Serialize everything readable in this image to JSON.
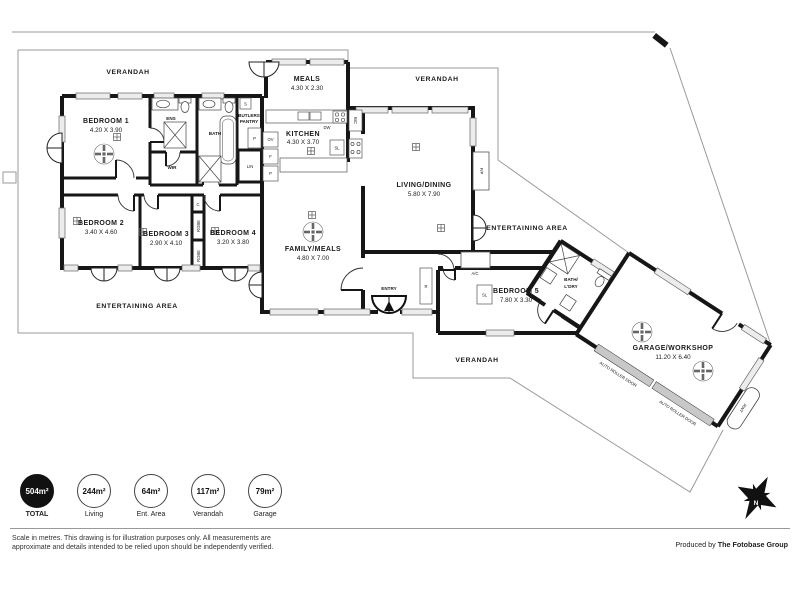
{
  "plan": {
    "verandah_nw": "VERANDAH",
    "verandah_ne": "VERANDAH",
    "verandah_s": "VERANDAH",
    "entertaining_w": "ENTERTAINING AREA",
    "entertaining_e": "ENTERTAINING AREA",
    "rooms": {
      "bedroom1": {
        "name": "BEDROOM 1",
        "dims": "4.20 X 3.90"
      },
      "bedroom2": {
        "name": "BEDROOM 2",
        "dims": "3.40 X 4.60"
      },
      "bedroom3": {
        "name": "BEDROOM 3",
        "dims": "2.90 X 4.10"
      },
      "bedroom4": {
        "name": "BEDROOM 4",
        "dims": "3.20 X 3.80"
      },
      "bedroom5": {
        "name": "BEDROOM 5",
        "dims": "7.80 X 3.30"
      },
      "meals": {
        "name": "MEALS",
        "dims": "4.30 X 2.30"
      },
      "kitchen": {
        "name": "KITCHEN",
        "dims": "4.30 X 3.70"
      },
      "family": {
        "name": "FAMILY/MEALS",
        "dims": "4.80 X 7.00"
      },
      "living": {
        "name": "LIVING/DINING",
        "dims": "5.80 X 7.90"
      },
      "garage": {
        "name": "GARAGE/WORKSHOP",
        "dims": "11.20 X 6.40"
      },
      "ens": "ENS",
      "bath": "BATH",
      "wir": "WIR",
      "butlers": {
        "line1": "BUTLERS",
        "line2": "PANTRY"
      },
      "bathldry": {
        "line1": "BATH/",
        "line2": "L'DRY"
      },
      "entry": "ENTRY"
    },
    "small": {
      "dw": "DW",
      "bic": "BIC",
      "sl": "SL",
      "sl_bed5": "SL",
      "ac": "A/C",
      "fp": "F/P",
      "s": "S",
      "p_bp": "P",
      "ov": "OV",
      "f": "F",
      "p_k": "P",
      "lin": "LIN",
      "c": "C",
      "robe1": "ROBE",
      "robe2": "ROBE",
      "r": "R",
      "rwt": "RWT",
      "roller1": "AUTO ROLLER DOOR",
      "roller2": "AUTO ROLLER DOOR"
    },
    "compass": "N"
  },
  "footer": {
    "stats": [
      {
        "value": "504m²",
        "label": "TOTAL"
      },
      {
        "value": "244m²",
        "label": "Living"
      },
      {
        "value": "64m²",
        "label": "Ent. Area"
      },
      {
        "value": "117m²",
        "label": "Verandah"
      },
      {
        "value": "79m²",
        "label": "Garage"
      }
    ],
    "disclaimer1": "Scale in metres. This drawing is for illustration purposes only. All measurements are",
    "disclaimer2": "approximate and details intended to be relied upon should be independently verified.",
    "produced_by": "Produced by ",
    "company": "The Fotobase Group"
  },
  "colors": {
    "wall": "#161616",
    "boundary": "#9a9a9a",
    "window": "#ececec",
    "total_circle": "#111111"
  }
}
